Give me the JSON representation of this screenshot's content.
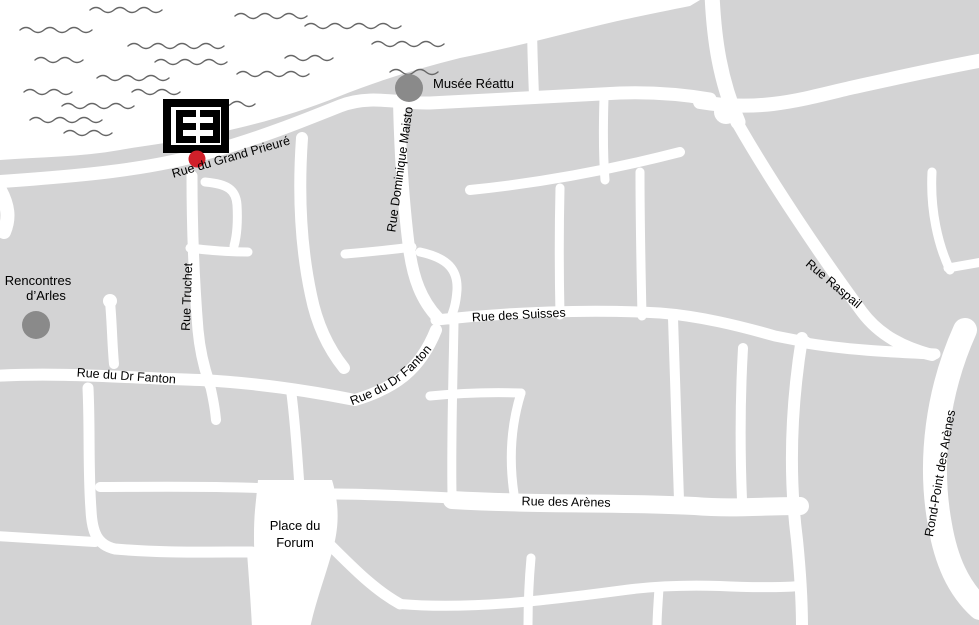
{
  "colors": {
    "land": "#d3d3d4",
    "river": "#ffffff",
    "street": "#ffffff",
    "landmark_dot": "#8a8a8a",
    "marker_red": "#d0202a",
    "logo": "#000000",
    "wave": "#666666",
    "text": "#000000"
  },
  "labels": {
    "musee_reattu": "Musée Réattu",
    "rencontres_line1": "Rencontres",
    "rencontres_line2": "d’Arles",
    "grand_prieure": "Rue du Grand Prieuré",
    "truchet": "Rue Truchet",
    "dominique_maisto": "Rue Dominique Maisto",
    "suisses": "Rue des Suisses",
    "dr_fanton_west": "Rue du Dr Fanton",
    "dr_fanton_mid": "Rue du Dr Fanton",
    "arenes": "Rue des Arènes",
    "raspail": "Rue Raspail",
    "rond_point": "Rond-Point des Arènes",
    "forum_line1": "Place du",
    "forum_line2": "Forum"
  },
  "markers": {
    "venue_logo": "black-square-EE-logo",
    "venue_point": "red-dot",
    "musee_reattu_point": "gray-dot",
    "rencontres_point": "gray-dot"
  }
}
